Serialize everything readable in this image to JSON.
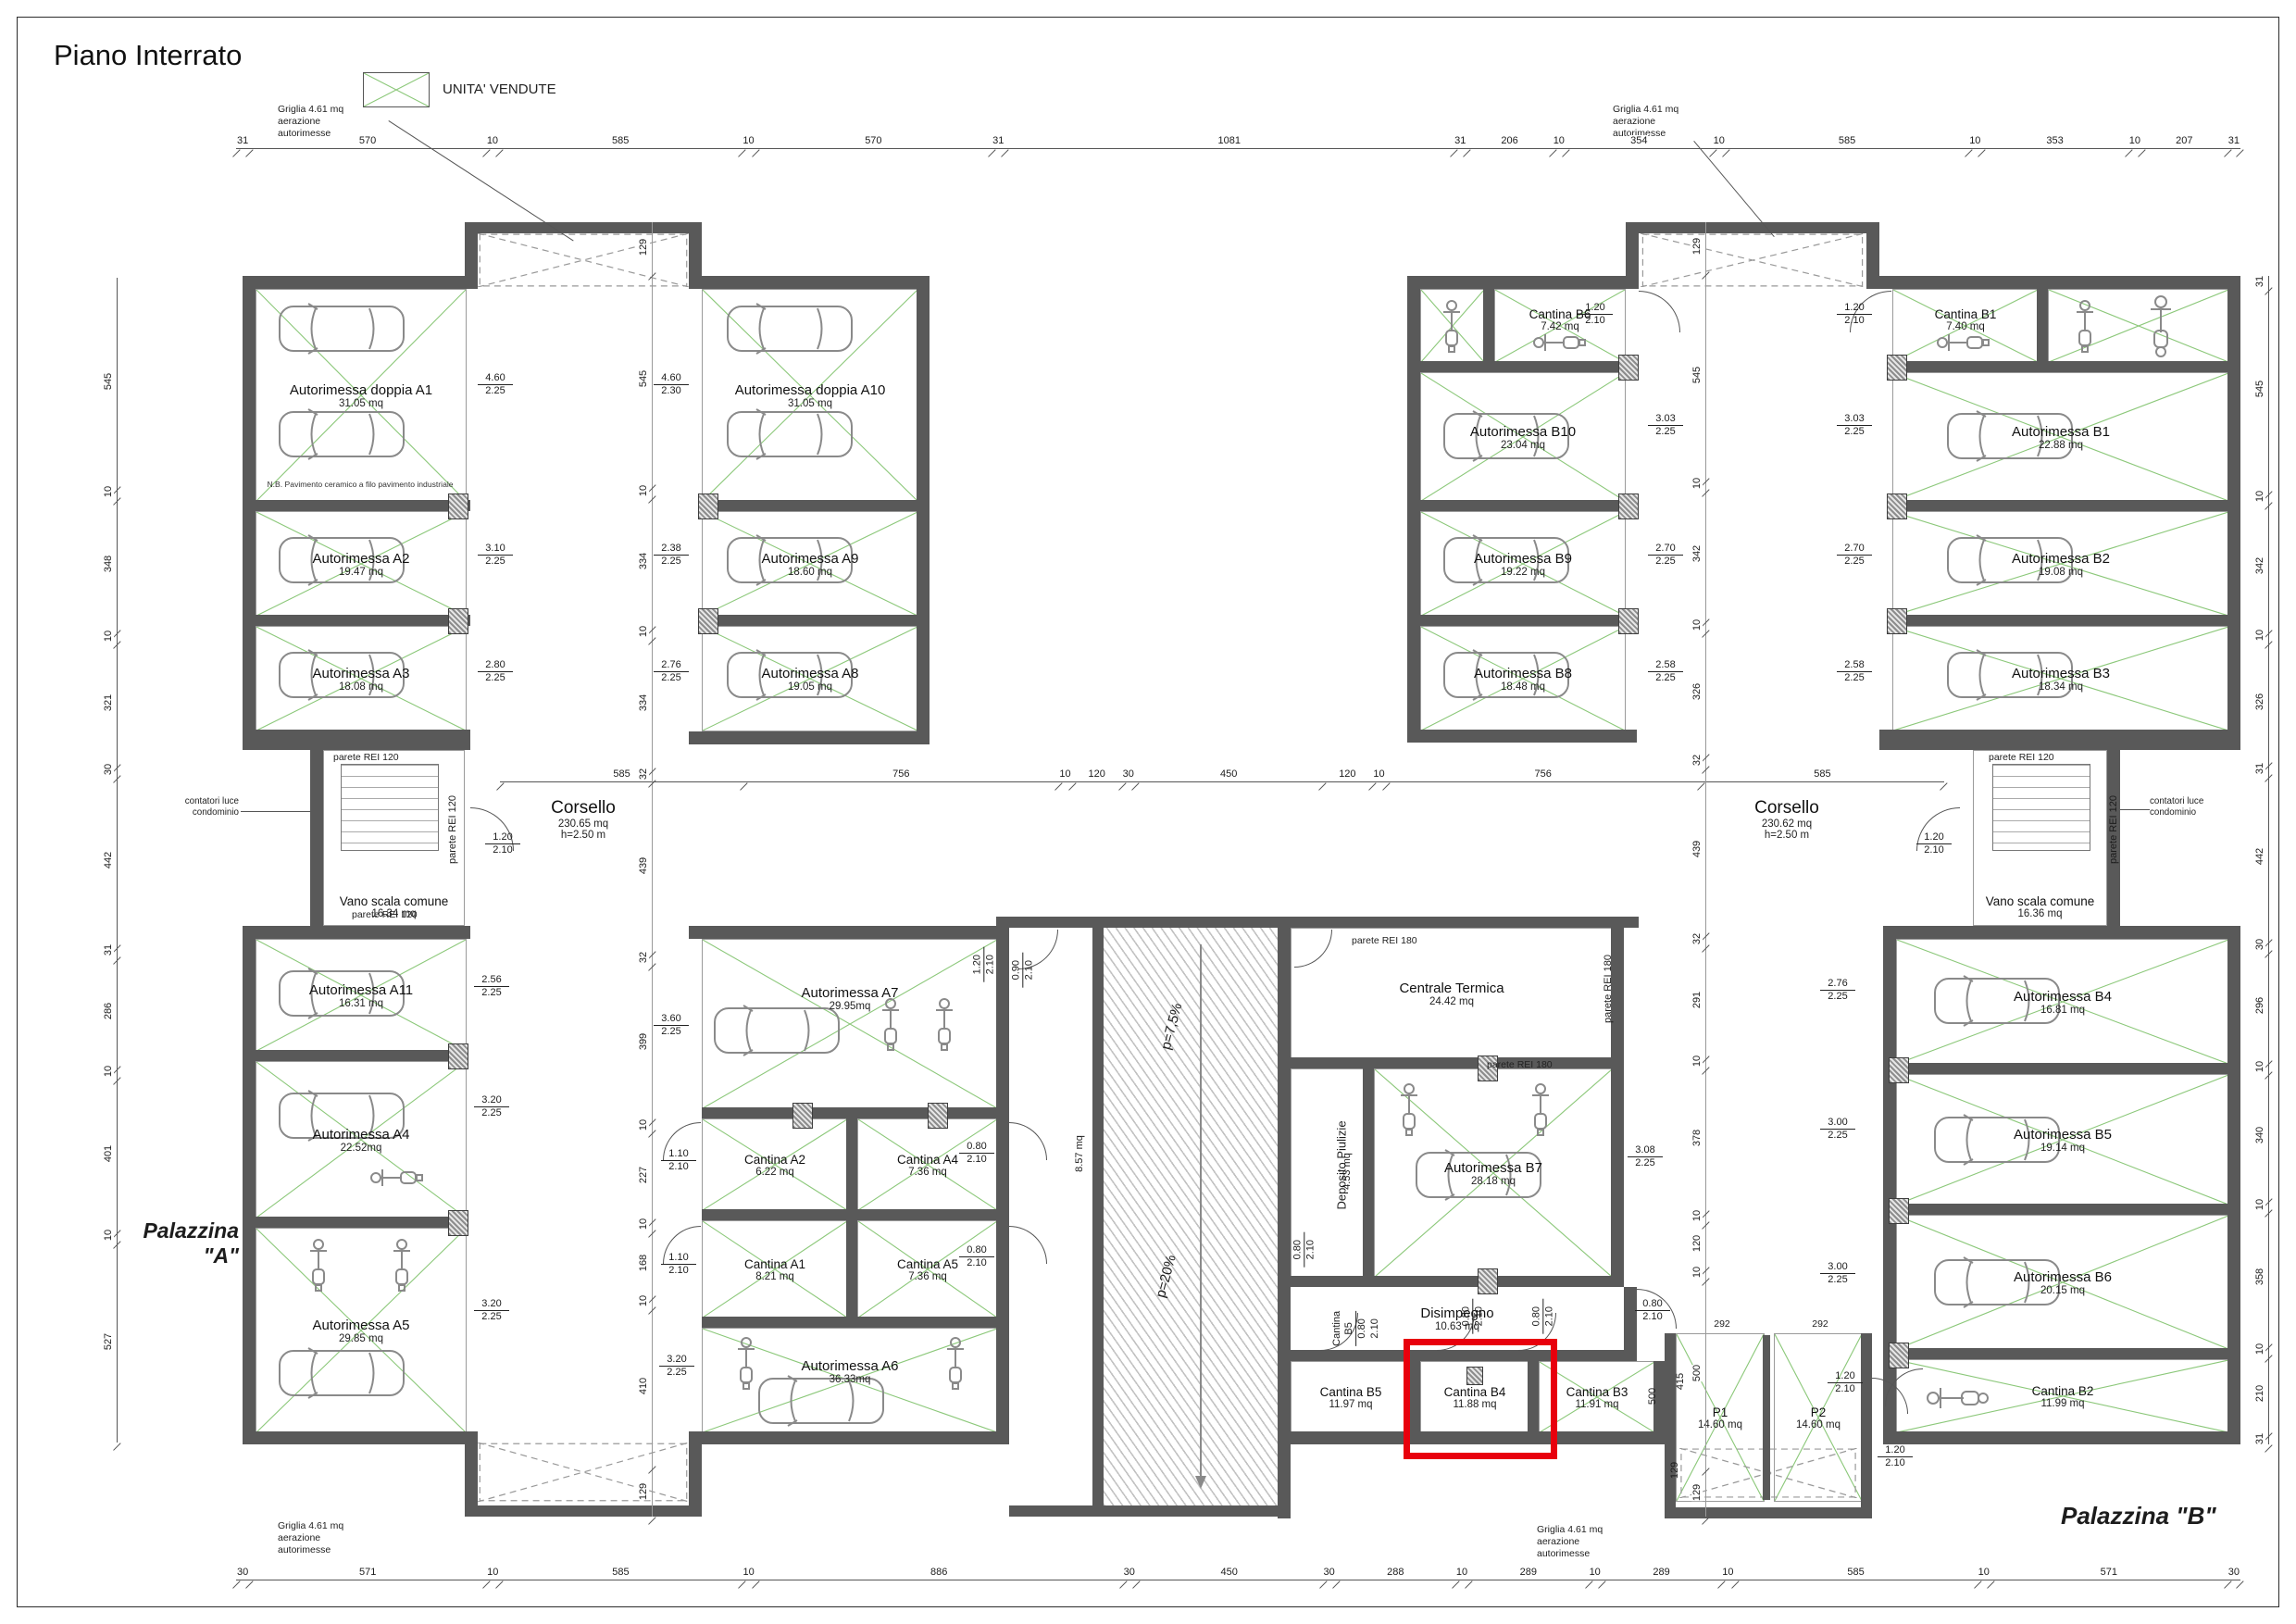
{
  "sheet": {
    "title": "Piano Interrato",
    "legend_label": "UNITA' VENDUTE"
  },
  "labels": {
    "palazzina_a": "Palazzina \"A\"",
    "palazzina_b": "Palazzina \"B\"",
    "griglia_l1": "Griglia  4.61 mq",
    "griglia_l2": "aerazione",
    "griglia_l3": "autorimesse",
    "parete_rei_120": "parete REI 120",
    "parete_rei_180": "parete REI 180",
    "contatori_l1": "contatori luce",
    "contatori_l2": "condominio",
    "ramp_upper": "p=7,5%",
    "ramp_lower": "p=20%"
  },
  "A": {
    "a1": {
      "name": "Autorimessa doppia A1",
      "area": "31.05 mq",
      "w": "4.60",
      "h": "2.25",
      "note": "N.B. Pavimento ceramico a filo pavimento industriale"
    },
    "a2": {
      "name": "Autorimessa A2",
      "area": "19.47 mq",
      "w": "3.10",
      "h": "2.25"
    },
    "a3": {
      "name": "Autorimessa A3",
      "area": "18.08 mq",
      "w": "2.80",
      "h": "2.25"
    },
    "a10": {
      "name": "Autorimessa doppia A10",
      "area": "31.05 mq",
      "w": "4.60",
      "h": "2.30"
    },
    "a9": {
      "name": "Autorimessa A9",
      "area": "18.60 mq",
      "w": "2.38",
      "h": "2.25"
    },
    "a8": {
      "name": "Autorimessa A8",
      "area": "19.05 mq",
      "w": "2.76",
      "h": "2.25"
    },
    "a11": {
      "name": "Autorimessa A11",
      "area": "16.31 mq",
      "w": "2.56",
      "h": "2.25"
    },
    "a4": {
      "name": "Autorimessa A4",
      "area": "22.52mq",
      "w": "3.20",
      "h": "2.25"
    },
    "a5": {
      "name": "Autorimessa A5",
      "area": "29.85 mq",
      "w": "3.20",
      "h": "2.25"
    },
    "a7": {
      "name": "Autorimessa A7",
      "area": "29.95mq",
      "w": "3.60",
      "h": "2.25",
      "dw": "1.20",
      "dh": "2.10"
    },
    "a6": {
      "name": "Autorimessa A6",
      "area": "36.33mq",
      "w": "3.20",
      "h": "2.25"
    },
    "ca2": {
      "name": "Cantina A2",
      "area": "6.22 mq",
      "dw": "1.10",
      "dh": "2.10"
    },
    "ca4": {
      "name": "Cantina A4",
      "area": "7.36 mq",
      "dw": "0.80",
      "dh": "2.10"
    },
    "ca1": {
      "name": "Cantina A1",
      "area": "8.21 mq",
      "dw": "1.10",
      "dh": "2.10"
    },
    "ca5": {
      "name": "Cantina A5",
      "area": "7.36 mq",
      "dw": "0.80",
      "dh": "2.10"
    },
    "corr": {
      "area": "8.57 mq",
      "dw": "0.90",
      "dh": "2.10"
    },
    "vano": {
      "name": "Vano scala comune",
      "area": "16.34 mq",
      "dw": "1.20",
      "dh": "2.10"
    },
    "corsello": {
      "name": "Corsello",
      "area": "230.65 mq",
      "hline": "h=2.50 m"
    }
  },
  "B": {
    "cb6": {
      "name": "Cantina B6",
      "area": "7.42 mq",
      "dw": "1.20",
      "dh": "2.10"
    },
    "b10": {
      "name": "Autorimessa B10",
      "area": "23.04 mq",
      "w": "3.03",
      "h": "2.25"
    },
    "b9": {
      "name": "Autorimessa B9",
      "area": "19.22 mq",
      "w": "2.70",
      "h": "2.25"
    },
    "b8": {
      "name": "Autorimessa B8",
      "area": "18.48 mq",
      "w": "2.58",
      "h": "2.25"
    },
    "cb1": {
      "name": "Cantina B1",
      "area": "7.40 mq",
      "dw": "1.20",
      "dh": "2.10"
    },
    "b1": {
      "name": "Autorimessa B1",
      "area": "22.88 mq",
      "w": "3.03",
      "h": "2.25"
    },
    "b2": {
      "name": "Autorimessa B2",
      "area": "19.08 mq",
      "w": "2.70",
      "h": "2.25"
    },
    "b3": {
      "name": "Autorimessa B3",
      "area": "18.34 mq",
      "w": "2.58",
      "h": "2.25"
    },
    "vano": {
      "name": "Vano scala comune",
      "area": "16.36 mq",
      "dw": "1.20",
      "dh": "2.10"
    },
    "corsello": {
      "name": "Corsello",
      "area": "230.62 mq",
      "hline": "h=2.50 m"
    },
    "ct": {
      "name": "Centrale Termica",
      "area": "24.42 mq"
    },
    "dep": {
      "name": "Deposito Piulizie",
      "area": "4.53 mq",
      "dw": "0.80",
      "dh": "2.10"
    },
    "b7": {
      "name": "Autorimessa B7",
      "area": "28.18 mq",
      "w": "3.08",
      "h": "2.25"
    },
    "dis": {
      "name": "Disimpegno",
      "area": "10.63 mq",
      "dw": "0.80",
      "dh": "2.10"
    },
    "cb5": {
      "name": "Cantina B5",
      "area": "11.97 mq"
    },
    "cb4": {
      "name": "Cantina B4",
      "area": "11.88 mq",
      "dw": "0.80",
      "dh": "2.10"
    },
    "cb3": {
      "name": "Cantina B3",
      "area": "11.91 mq",
      "dw": "0.80",
      "dh": "2.10"
    },
    "p1": {
      "name": "P1",
      "area": "14.60 mq"
    },
    "p2": {
      "name": "P2",
      "area": "14.60 mq",
      "dw": "1.20",
      "dh": "2.10"
    },
    "gb4": {
      "name": "Autorimessa B4",
      "area": "16.81 mq",
      "w": "2.76",
      "h": "2.25"
    },
    "gb5": {
      "name": "Autorimessa B5",
      "area": "19.14 mq",
      "w": "3.00",
      "h": "2.25"
    },
    "gb6": {
      "name": "Autorimessa B6",
      "area": "20.15 mq",
      "w": "3.00",
      "h": "2.25"
    },
    "cb2": {
      "name": "Cantina B2",
      "area": "11.99 mq",
      "dw": "1.20",
      "dh": "2.10"
    },
    "pd": {
      "w1": "292",
      "w2": "292",
      "v415": "415",
      "v500": "500",
      "v129": "129"
    }
  },
  "dims": {
    "top": [
      "31",
      "570",
      "10",
      "585",
      "10",
      "570",
      "31",
      "1081",
      "31",
      "206",
      "10",
      "354",
      "10",
      "585",
      "10",
      "353",
      "10",
      "207",
      "31"
    ],
    "bottom": [
      "30",
      "571",
      "10",
      "585",
      "10",
      "886",
      "30",
      "450",
      "30",
      "288",
      "10",
      "289",
      "10",
      "289",
      "10",
      "585",
      "10",
      "571",
      "30"
    ],
    "middle": [
      "585",
      "756",
      "10",
      "120",
      "30",
      "450",
      "120",
      "10",
      "756",
      "585"
    ],
    "left": [
      "545",
      "10",
      "348",
      "10",
      "321",
      "30",
      "442",
      "31",
      "286",
      "10",
      "401",
      "10",
      "527"
    ],
    "right": [
      "31",
      "545",
      "10",
      "342",
      "10",
      "326",
      "31",
      "442",
      "30",
      "296",
      "10",
      "340",
      "10",
      "358",
      "10",
      "210",
      "31"
    ],
    "innerA": [
      "129",
      "545",
      "10",
      "334",
      "10",
      "334",
      "32",
      "439",
      "32",
      "399",
      "10",
      "227",
      "10",
      "168",
      "10",
      "410",
      "129"
    ],
    "innerB": [
      "129",
      "545",
      "10",
      "342",
      "10",
      "326",
      "32",
      "439",
      "32",
      "291",
      "10",
      "378",
      "10",
      "120",
      "10",
      "500",
      "129"
    ]
  },
  "colors": {
    "wall": "#595959",
    "sold_green": "#8cc87a",
    "highlight_red": "#e8000d"
  }
}
